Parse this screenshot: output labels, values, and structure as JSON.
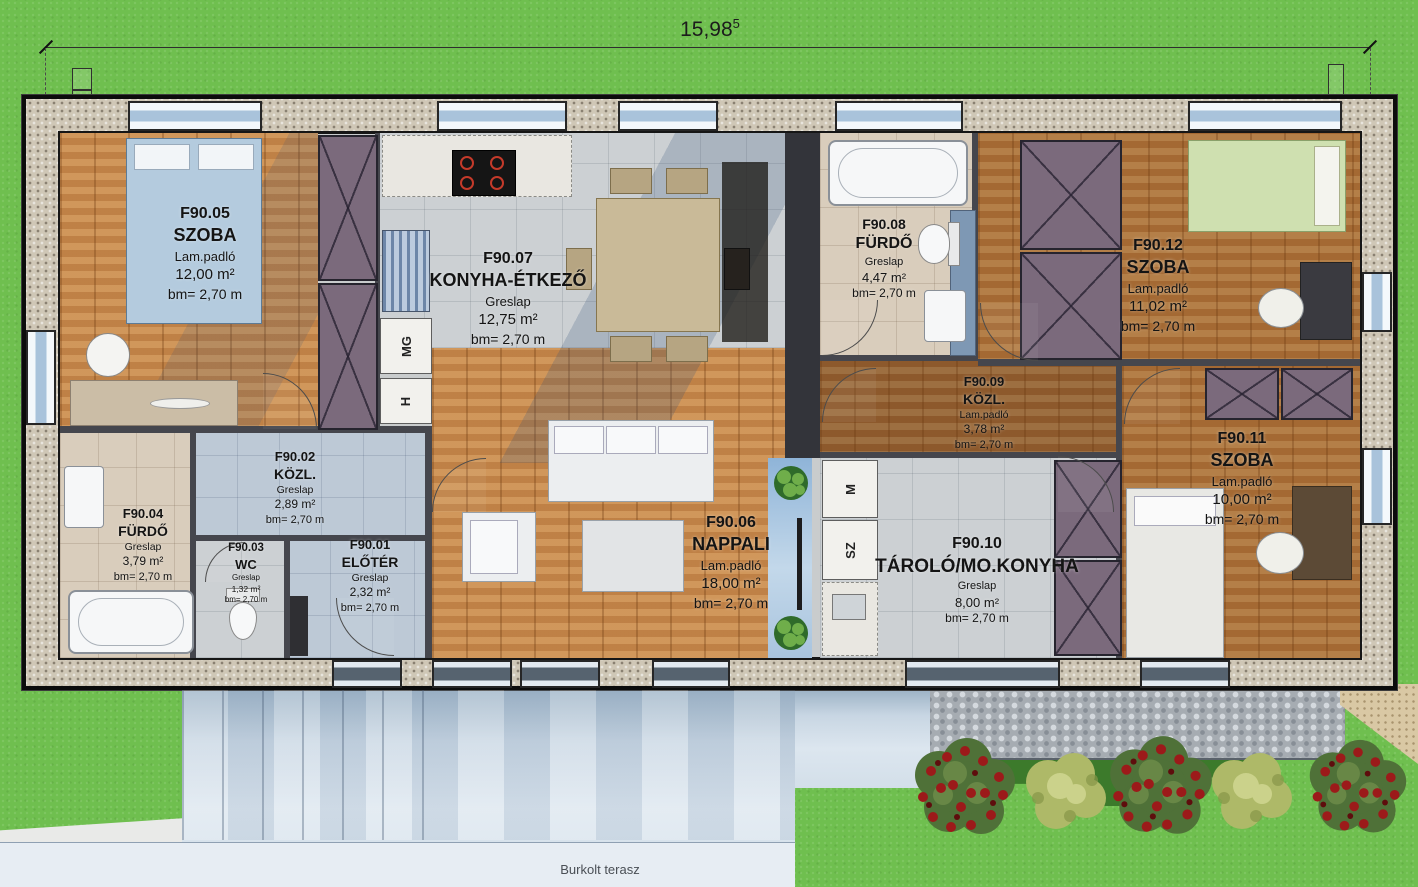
{
  "plan": {
    "dimension": {
      "value": "15,98",
      "sup": "5"
    },
    "terrace_label": "Burkolt terasz"
  },
  "rooms": [
    {
      "id": "F90.01",
      "name": "ELŐTÉR",
      "floor": "Greslap",
      "area": "2,32 m²",
      "height": "bm= 2,70 m"
    },
    {
      "id": "F90.02",
      "name": "KÖZL.",
      "floor": "Greslap",
      "area": "2,89 m²",
      "height": "bm= 2,70 m"
    },
    {
      "id": "F90.03",
      "name": "WC",
      "floor": "Greslap",
      "area": "1,32 m²",
      "height": "bm= 2,70 m"
    },
    {
      "id": "F90.04",
      "name": "FÜRDŐ",
      "floor": "Greslap",
      "area": "3,79 m²",
      "height": "bm= 2,70 m"
    },
    {
      "id": "F90.05",
      "name": "SZOBA",
      "floor": "Lam.padló",
      "area": "12,00 m²",
      "height": "bm= 2,70 m"
    },
    {
      "id": "F90.06",
      "name": "NAPPALI",
      "floor": "Lam.padló",
      "area": "18,00 m²",
      "height": "bm= 2,70 m"
    },
    {
      "id": "F90.07",
      "name": "KONYHA-ÉTKEZŐ",
      "floor": "Greslap",
      "area": "12,75 m²",
      "height": "bm= 2,70 m"
    },
    {
      "id": "F90.08",
      "name": "FÜRDŐ",
      "floor": "Greslap",
      "area": "4,47 m²",
      "height": "bm= 2,70 m"
    },
    {
      "id": "F90.09",
      "name": "KÖZL.",
      "floor": "Lam.padló",
      "area": "3,78 m²",
      "height": "bm= 2,70 m"
    },
    {
      "id": "F90.10",
      "name": "TÁROLÓ/MO.KONYHA",
      "floor": "Greslap",
      "area": "8,00 m²",
      "height": "bm= 2,70 m"
    },
    {
      "id": "F90.11",
      "name": "SZOBA",
      "floor": "Lam.padló",
      "area": "10,00 m²",
      "height": "bm= 2,70 m"
    },
    {
      "id": "F90.12",
      "name": "SZOBA",
      "floor": "Lam.padló",
      "area": "11,02 m²",
      "height": "bm= 2,70 m"
    }
  ],
  "appliances": {
    "dishwasher": "MG",
    "fridge": "H",
    "washing_machine": "M",
    "dryer": "SZ"
  },
  "colors": {
    "grass": "#6fbf4f",
    "wood": "#c98b4e",
    "tile_gray": "#ccd0d3",
    "tile_beige": "#d9cdbc",
    "wardrobe_purple": "#7b6a7c",
    "terrace_blue": "#c8d6e3",
    "rose_red": "#9c1a1a",
    "wall_band": "#cfc7b6"
  }
}
